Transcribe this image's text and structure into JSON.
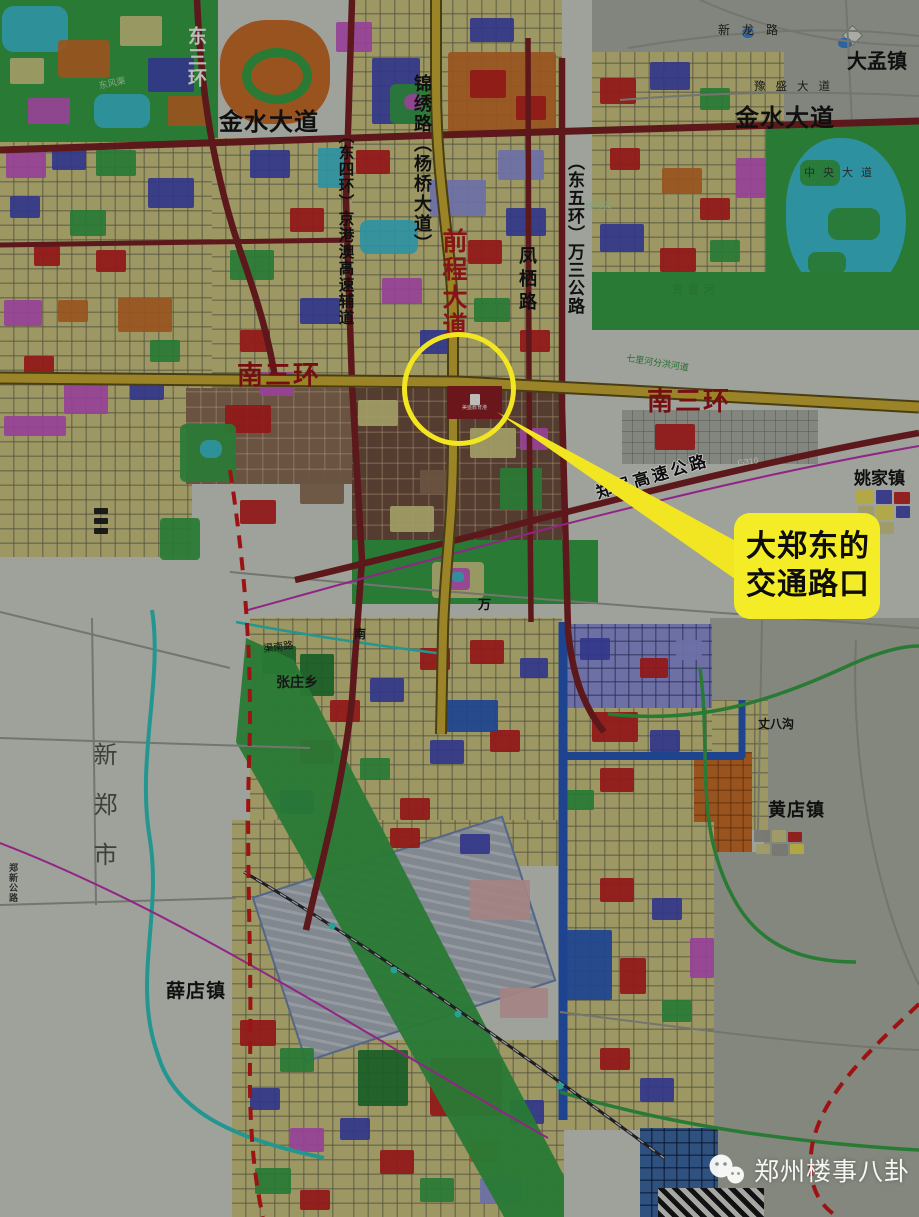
{
  "labels": {
    "east_third_ring": {
      "text": "东三环"
    },
    "jinshui_ave_west": {
      "text": "金水大道"
    },
    "jinxiu_rd": {
      "text": "锦绣路（杨桥大道）"
    },
    "dongsihuan_jinggangao": {
      "text": "（东四环）京港澳高速辅道"
    },
    "qiancheng_ave": {
      "text": "前程大道"
    },
    "fengqi_rd": {
      "text": "凤栖路"
    },
    "dongwuhuan_wansan": {
      "text": "（东五环）万三公路"
    },
    "xinlong_rd": {
      "text": "新龙路"
    },
    "dameng_town": {
      "text": "大孟镇"
    },
    "yusheng_ave": {
      "text": "豫盛大道"
    },
    "jinshui_ave_east": {
      "text": "金水大道"
    },
    "central_ave": {
      "text": "中央大道"
    },
    "lvbo_garden": {
      "text": "绿博园"
    },
    "jialu_river": {
      "text": "贾鲁河"
    },
    "qilihe_channel": {
      "text": "七里河分洪河道"
    },
    "south_third_ring_west": {
      "text": "南三环"
    },
    "south_third_ring_east": {
      "text": "南三环"
    },
    "g310": {
      "text": "G310"
    },
    "zhengmin_expressway": {
      "text": "郑民高速公路"
    },
    "yaojia_town": {
      "text": "姚家镇"
    },
    "wan_char": {
      "text": "万"
    },
    "nan_char": {
      "text": "南"
    },
    "qunan_rd": {
      "text": "渠南路"
    },
    "zhangzhuang_township": {
      "text": "张庄乡"
    },
    "zhangba_ditch": {
      "text": "丈八沟"
    },
    "xinzheng_city": {
      "text": "新郑市"
    },
    "zhengxin_highway": {
      "text": "郑新公路"
    },
    "huangdian_town": {
      "text": "黄店镇"
    },
    "xuedian_town": {
      "text": "薛店镇"
    },
    "dongfeng_canal": {
      "text": "东风渠"
    },
    "project_block": {
      "text": "美盛教育港"
    }
  },
  "annotation": {
    "line1": "大郑东的",
    "line2": "交通路口"
  },
  "watermark": {
    "text": "郑州楼事八卦",
    "icon": "wechat-icon"
  },
  "colors": {
    "annotation_yellow": "#f2e522",
    "callout_yellow": "#f5ec28",
    "road_dark_red": "#7a1d20",
    "road_yellow": "#c9a92c",
    "boundary_dashed_red": "#d21616",
    "river_cyan": "#25c2ba",
    "rail_magenta": "#c02cb0",
    "park_green": "#2f9e3f",
    "block_yellow": "#c9c27b",
    "watermark_white": "#ffffff"
  }
}
